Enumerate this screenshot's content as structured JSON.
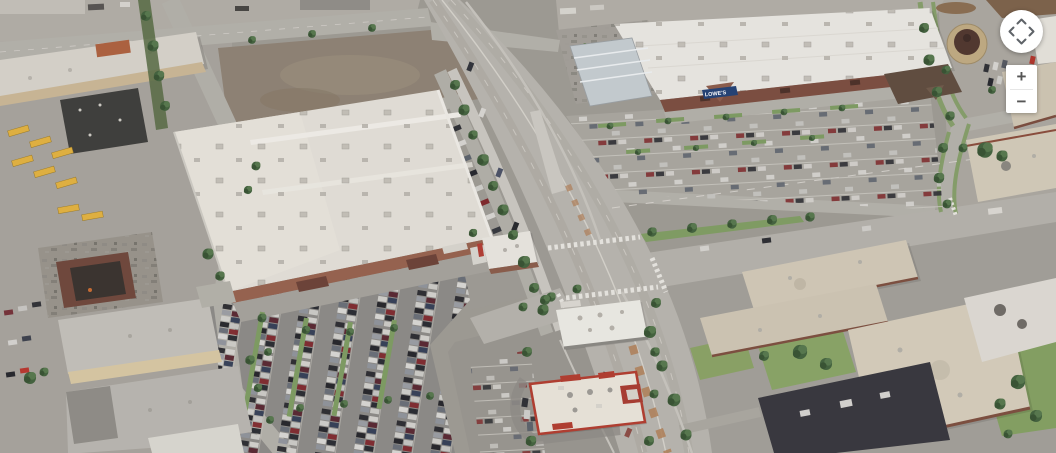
{
  "map": {
    "view": "aerial-satellite",
    "visible_signs": {
      "lowes_storefront": "LOWE'S"
    },
    "palette": {
      "concrete_road": "#b8b5ad",
      "asphalt_lot": "#8c8a85",
      "white_roof": "#e9e7e1",
      "tan_roof": "#d2c9b6",
      "dark_roof": "#35343a",
      "brick_facade": "#7b4b3d",
      "grass": "#86a262",
      "tree": "#41603a",
      "dirt": "#8e8172",
      "school_bus_yellow": "#e3b23d",
      "lowes_sign_blue": "#203f72",
      "fastfood_red": "#b23a2c"
    },
    "features": [
      "big-box store with white roof and full parking lot (west)",
      "Lowe's home improvement store with garden center (northeast)",
      "multi-lane arterial road running north-south",
      "cross street heading east",
      "fast-food outparcel restaurants (bottom center)",
      "tan-roof industrial park (southeast)",
      "school bus yard and industrial lots (west)",
      "vacant dirt lot (north center)",
      "domed round building (top right)"
    ]
  },
  "controls": {
    "pan": {
      "up_icon": "chevron-up",
      "down_icon": "chevron-down",
      "left_icon": "chevron-left",
      "right_icon": "chevron-right"
    },
    "zoom": {
      "zoom_in_label": "+",
      "zoom_out_label": "−"
    }
  }
}
